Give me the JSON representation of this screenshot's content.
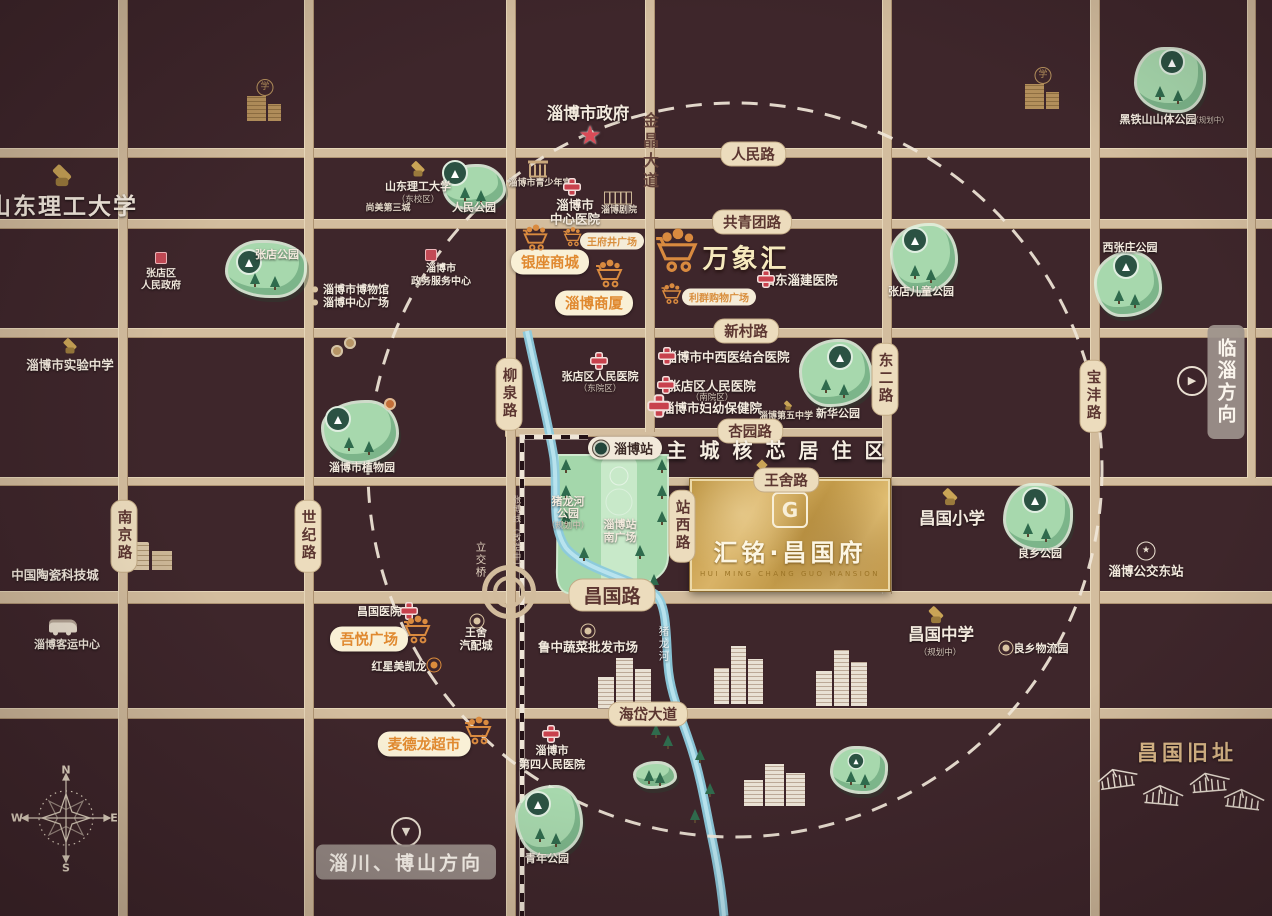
{
  "colors": {
    "bg": "#3E262B",
    "road": "#D3BD9E",
    "pill_bg": "#ECDCBD",
    "park_green": "#A7D8AD",
    "river_blue": "#8CCADD",
    "plate_gold": "#D3A753",
    "accent_yellow": "#E0892F",
    "cross_red": "#C8414D"
  },
  "plate": {
    "logo": "G",
    "name": "汇铭·昌国府",
    "name_en": "HUI MING CHANG GUO MANSION"
  },
  "slogan": "主城核芯居住区",
  "station": {
    "label": "淄博站"
  },
  "directions": {
    "east": "临淄方向",
    "east_arrow": "▶",
    "southwest": "淄川、博山方向",
    "southwest_arrow": "▼"
  },
  "compass": {
    "n": "N",
    "e": "E",
    "s": "S",
    "w": "W"
  },
  "glyphs": {
    "school": "学",
    "star": "★",
    "bullet": "●"
  },
  "roads": {
    "segments": [
      {
        "d": "h",
        "x": 0,
        "y": 148,
        "l": 1272,
        "t": 8
      },
      {
        "d": "h",
        "x": 0,
        "y": 219,
        "l": 1272,
        "t": 8
      },
      {
        "d": "h",
        "x": 0,
        "y": 328,
        "l": 1272,
        "t": 8
      },
      {
        "d": "h",
        "x": 505,
        "y": 428,
        "l": 385,
        "t": 7
      },
      {
        "d": "h",
        "x": 0,
        "y": 477,
        "l": 1272,
        "t": 7
      },
      {
        "d": "h",
        "x": 0,
        "y": 591,
        "l": 1272,
        "t": 11
      },
      {
        "d": "h",
        "x": 0,
        "y": 708,
        "l": 1272,
        "t": 9
      },
      {
        "d": "v",
        "x": 118,
        "y": 0,
        "l": 916,
        "t": 8
      },
      {
        "d": "v",
        "x": 304,
        "y": 0,
        "l": 916,
        "t": 8
      },
      {
        "d": "v",
        "x": 506,
        "y": 0,
        "l": 916,
        "t": 8
      },
      {
        "d": "v",
        "x": 645,
        "y": 0,
        "l": 432,
        "t": 8
      },
      {
        "d": "v",
        "x": 882,
        "y": 0,
        "l": 594,
        "t": 8
      },
      {
        "d": "v",
        "x": 1090,
        "y": 0,
        "l": 916,
        "t": 8
      },
      {
        "d": "v",
        "x": 1247,
        "y": 0,
        "l": 478,
        "t": 7
      }
    ],
    "pills": [
      {
        "t": "人民路",
        "x": 753,
        "y": 154
      },
      {
        "t": "共青团路",
        "x": 752,
        "y": 222
      },
      {
        "t": "新村路",
        "x": 746,
        "y": 331
      },
      {
        "t": "杏园路",
        "x": 750,
        "y": 431
      },
      {
        "t": "王舍路",
        "x": 786,
        "y": 480
      },
      {
        "t": "昌国路",
        "x": 612,
        "y": 595,
        "big": true
      },
      {
        "t": "海岱大道",
        "x": 648,
        "y": 714
      },
      {
        "t": "柳泉路",
        "x": 509,
        "y": 394,
        "v": true
      },
      {
        "t": "南京路",
        "x": 124,
        "y": 536,
        "v": true
      },
      {
        "t": "世纪路",
        "x": 308,
        "y": 536,
        "v": true
      },
      {
        "t": "东二路",
        "x": 885,
        "y": 379,
        "v": true
      },
      {
        "t": "宝沣路",
        "x": 1093,
        "y": 396,
        "v": true
      },
      {
        "t": "站西路",
        "x": 682,
        "y": 526,
        "v": true
      }
    ],
    "names": [
      {
        "t": "金晶大道",
        "x": 649,
        "y": 152
      }
    ]
  },
  "labels": [
    {
      "t": "山东理工大学",
      "x": 63,
      "y": 204,
      "c": "huge"
    },
    {
      "t": "淄博市政府",
      "x": 588,
      "y": 112,
      "c": "big"
    },
    {
      "t": "山东理工大学",
      "x": 418,
      "y": 186,
      "c": "s11"
    },
    {
      "t": "（东校区）",
      "x": 418,
      "y": 199,
      "c": "sub"
    },
    {
      "t": "尚美第三城",
      "x": 388,
      "y": 207,
      "c": "tiny"
    },
    {
      "t": "人民公园",
      "x": 474,
      "y": 207,
      "c": "s11"
    },
    {
      "t": "淄博市青少年宫",
      "x": 540,
      "y": 182,
      "c": "tiny"
    },
    {
      "t": "淄博市",
      "x": 575,
      "y": 204,
      "c": "w"
    },
    {
      "t": "中心医院",
      "x": 575,
      "y": 218,
      "c": "w"
    },
    {
      "t": "淄博剧院",
      "x": 619,
      "y": 209,
      "c": "tiny"
    },
    {
      "t": "张店区",
      "x": 161,
      "y": 272,
      "c": "t10"
    },
    {
      "t": "人民政府",
      "x": 161,
      "y": 284,
      "c": "t10"
    },
    {
      "t": "张店公园",
      "x": 277,
      "y": 254,
      "c": "s11"
    },
    {
      "t": "淄博市博物馆",
      "x": 356,
      "y": 289,
      "c": "s11"
    },
    {
      "t": "淄博中心广场",
      "x": 356,
      "y": 302,
      "c": "s11"
    },
    {
      "t": "淄博市",
      "x": 441,
      "y": 267,
      "c": "t10"
    },
    {
      "t": "政务服务中心",
      "x": 441,
      "y": 280,
      "c": "t10"
    },
    {
      "t": "银座商城",
      "x": 550,
      "y": 262,
      "c": "ypill"
    },
    {
      "t": "王府井广场",
      "x": 612,
      "y": 241,
      "c": "cpill"
    },
    {
      "t": "万象汇",
      "x": 746,
      "y": 257,
      "c": "ymega"
    },
    {
      "t": "山东淄建医院",
      "x": 800,
      "y": 279,
      "c": "w"
    },
    {
      "t": "利群购物广场",
      "x": 719,
      "y": 297,
      "c": "cpill"
    },
    {
      "t": "淄博商厦",
      "x": 594,
      "y": 303,
      "c": "ypill"
    },
    {
      "t": "张店儿童公园",
      "x": 921,
      "y": 291,
      "c": "s11"
    },
    {
      "t": "西张庄公园",
      "x": 1130,
      "y": 247,
      "c": "s11"
    },
    {
      "t": "黑铁山山体公园",
      "x": 1158,
      "y": 119,
      "c": "s11"
    },
    {
      "t": "（规划中）",
      "x": 1210,
      "y": 120,
      "c": "sub7"
    },
    {
      "t": "淄博市实验中学",
      "x": 70,
      "y": 364,
      "c": "w"
    },
    {
      "t": "淄博市植物园",
      "x": 362,
      "y": 467,
      "c": "s11"
    },
    {
      "t": "张店区人民医院",
      "x": 600,
      "y": 376,
      "c": "s11"
    },
    {
      "t": "（东院区）",
      "x": 600,
      "y": 388,
      "c": "sub"
    },
    {
      "t": "淄博市中西医结合医院",
      "x": 727,
      "y": 356,
      "c": "w"
    },
    {
      "t": "张店区人民医院",
      "x": 712,
      "y": 385,
      "c": "w"
    },
    {
      "t": "（南院区）",
      "x": 712,
      "y": 397,
      "c": "sub"
    },
    {
      "t": "淄博市妇幼保健院",
      "x": 712,
      "y": 407,
      "c": "w"
    },
    {
      "t": "淄博第五中学",
      "x": 786,
      "y": 415,
      "c": "tiny"
    },
    {
      "t": "新华公园",
      "x": 838,
      "y": 413,
      "c": "s11"
    },
    {
      "t": "猪龙河",
      "x": 568,
      "y": 501,
      "c": "s11"
    },
    {
      "t": "公园",
      "x": 568,
      "y": 513,
      "c": "s11"
    },
    {
      "t": "（规划中）",
      "x": 568,
      "y": 525,
      "c": "sub"
    },
    {
      "t": "淄博站",
      "x": 620,
      "y": 524,
      "c": "s11"
    },
    {
      "t": "南广场",
      "x": 620,
      "y": 537,
      "c": "s11"
    },
    {
      "t": "张博线（改造中）",
      "x": 516,
      "y": 533,
      "c": "vdark"
    },
    {
      "t": "立交桥",
      "x": 481,
      "y": 560,
      "c": "vlight"
    },
    {
      "t": "昌国小学",
      "x": 952,
      "y": 517,
      "c": "big"
    },
    {
      "t": "良乡公园",
      "x": 1040,
      "y": 553,
      "c": "s11"
    },
    {
      "t": "淄博公交东站",
      "x": 1146,
      "y": 570,
      "c": "w"
    },
    {
      "t": "中国陶瓷科技城",
      "x": 55,
      "y": 574,
      "c": "w"
    },
    {
      "t": "淄博客运中心",
      "x": 67,
      "y": 644,
      "c": "s11"
    },
    {
      "t": "昌国医院",
      "x": 379,
      "y": 611,
      "c": "s11"
    },
    {
      "t": "吾悦广场",
      "x": 369,
      "y": 639,
      "c": "ypill"
    },
    {
      "t": "红星美凯龙",
      "x": 399,
      "y": 666,
      "c": "s11"
    },
    {
      "t": "王舍",
      "x": 476,
      "y": 632,
      "c": "s11"
    },
    {
      "t": "汽配城",
      "x": 476,
      "y": 645,
      "c": "s11"
    },
    {
      "t": "鲁中蔬菜批发市场",
      "x": 588,
      "y": 646,
      "c": "w"
    },
    {
      "t": "猪龙河",
      "x": 664,
      "y": 644,
      "c": "vwhite"
    },
    {
      "t": "昌国中学",
      "x": 941,
      "y": 633,
      "c": "big"
    },
    {
      "t": "（规划中）",
      "x": 940,
      "y": 652,
      "c": "sub"
    },
    {
      "t": "良乡物流园",
      "x": 1041,
      "y": 648,
      "c": "s11"
    },
    {
      "t": "昌国旧址",
      "x": 1187,
      "y": 752,
      "c": "gold"
    },
    {
      "t": "麦德龙超市",
      "x": 424,
      "y": 744,
      "c": "ypill"
    },
    {
      "t": "淄博市",
      "x": 552,
      "y": 750,
      "c": "s11"
    },
    {
      "t": "第四人民医院",
      "x": 552,
      "y": 764,
      "c": "s11"
    },
    {
      "t": "青年公园",
      "x": 547,
      "y": 858,
      "c": "s11"
    }
  ],
  "parks": [
    {
      "x": 445,
      "y": 167,
      "w": 58,
      "h": 40,
      "bx": 455,
      "by": 173
    },
    {
      "x": 228,
      "y": 243,
      "w": 76,
      "h": 52,
      "bx": 249,
      "by": 262
    },
    {
      "x": 893,
      "y": 226,
      "w": 62,
      "h": 64,
      "bx": 915,
      "by": 240
    },
    {
      "x": 1097,
      "y": 254,
      "w": 62,
      "h": 60,
      "bx": 1126,
      "by": 266
    },
    {
      "x": 1137,
      "y": 50,
      "w": 66,
      "h": 60,
      "bx": 1172,
      "by": 62
    },
    {
      "x": 324,
      "y": 403,
      "w": 72,
      "h": 58,
      "bx": 338,
      "by": 419
    },
    {
      "x": 802,
      "y": 342,
      "w": 68,
      "h": 62,
      "bx": 840,
      "by": 357
    },
    {
      "x": 1006,
      "y": 486,
      "w": 64,
      "h": 62,
      "bx": 1035,
      "by": 500
    },
    {
      "x": 518,
      "y": 788,
      "w": 62,
      "h": 66,
      "bx": 538,
      "by": 804
    },
    {
      "x": 636,
      "y": 764,
      "w": 38,
      "h": 22
    },
    {
      "x": 833,
      "y": 749,
      "w": 52,
      "h": 42,
      "bx": 856,
      "by": 761,
      "sm": true
    }
  ],
  "icons": [
    {
      "k": "cross",
      "x": 572,
      "y": 187
    },
    {
      "k": "cross",
      "x": 599,
      "y": 361
    },
    {
      "k": "cross",
      "x": 667,
      "y": 356
    },
    {
      "k": "cross",
      "x": 666,
      "y": 385
    },
    {
      "k": "cross",
      "x": 659,
      "y": 406,
      "s": 1.3
    },
    {
      "k": "cross",
      "x": 766,
      "y": 279
    },
    {
      "k": "cross",
      "x": 409,
      "y": 611
    },
    {
      "k": "cross",
      "x": 551,
      "y": 734
    },
    {
      "k": "star",
      "x": 590,
      "y": 136
    },
    {
      "k": "gov",
      "x": 161,
      "y": 258
    },
    {
      "k": "gov",
      "x": 431,
      "y": 255
    },
    {
      "k": "cap",
      "x": 62,
      "y": 177,
      "s": 1.4
    },
    {
      "k": "cap",
      "x": 418,
      "y": 170,
      "s": 1
    },
    {
      "k": "cap",
      "x": 70,
      "y": 347,
      "s": 1
    },
    {
      "k": "cap",
      "x": 788,
      "y": 406,
      "s": 0.6
    },
    {
      "k": "cap",
      "x": 950,
      "y": 498,
      "s": 1.1
    },
    {
      "k": "cap",
      "x": 936,
      "y": 616,
      "s": 1.1
    },
    {
      "k": "schoolbld",
      "x": 265,
      "y": 100
    },
    {
      "k": "schoolbld",
      "x": 1043,
      "y": 88
    },
    {
      "k": "bank",
      "x": 538,
      "y": 171
    },
    {
      "k": "theater",
      "x": 618,
      "y": 198
    },
    {
      "k": "ceramic",
      "x": 152,
      "y": 556
    },
    {
      "k": "bus",
      "x": 63,
      "y": 626
    },
    {
      "k": "busstar",
      "x": 1146,
      "y": 551
    },
    {
      "k": "ring",
      "x": 477,
      "y": 621
    },
    {
      "k": "ring",
      "x": 588,
      "y": 631
    },
    {
      "k": "ring",
      "x": 1006,
      "y": 648
    },
    {
      "k": "ringo",
      "x": 434,
      "y": 665
    },
    {
      "k": "bullet",
      "x": 315,
      "y": 289
    },
    {
      "k": "bullet",
      "x": 315,
      "y": 302
    },
    {
      "k": "cart",
      "x": 536,
      "y": 240,
      "s": 30
    },
    {
      "k": "cart",
      "x": 573,
      "y": 239,
      "s": 22
    },
    {
      "k": "cart",
      "x": 678,
      "y": 253,
      "s": 50
    },
    {
      "k": "cart",
      "x": 610,
      "y": 276,
      "s": 32
    },
    {
      "k": "cart",
      "x": 672,
      "y": 296,
      "s": 24
    },
    {
      "k": "cart",
      "x": 418,
      "y": 632,
      "s": 32
    },
    {
      "k": "cart",
      "x": 479,
      "y": 733,
      "s": 32
    },
    {
      "k": "dotb",
      "x": 337,
      "y": 351
    },
    {
      "k": "dotb",
      "x": 350,
      "y": 343
    },
    {
      "k": "dotbo",
      "x": 390,
      "y": 404
    },
    {
      "k": "diamond",
      "x": 762,
      "y": 465
    },
    {
      "k": "intc",
      "x": 509,
      "y": 592
    }
  ],
  "clusters": [
    {
      "x": 598,
      "y": 658,
      "w": 54,
      "h": 50
    },
    {
      "x": 714,
      "y": 646,
      "w": 50,
      "h": 58
    },
    {
      "x": 816,
      "y": 650,
      "w": 52,
      "h": 56
    },
    {
      "x": 744,
      "y": 764,
      "w": 62,
      "h": 42
    }
  ],
  "trees": [
    [
      566,
      470
    ],
    [
      566,
      496
    ],
    [
      566,
      522
    ],
    [
      662,
      470
    ],
    [
      662,
      496
    ],
    [
      662,
      522
    ],
    [
      584,
      558
    ],
    [
      640,
      556
    ],
    [
      606,
      590
    ],
    [
      654,
      585
    ],
    [
      656,
      735
    ],
    [
      668,
      746
    ],
    [
      700,
      760
    ],
    [
      710,
      794
    ],
    [
      695,
      820
    ]
  ],
  "houses": [
    [
      1118,
      780,
      -8
    ],
    [
      1163,
      797,
      5
    ],
    [
      1210,
      784,
      -5
    ],
    [
      1244,
      801,
      7
    ]
  ]
}
